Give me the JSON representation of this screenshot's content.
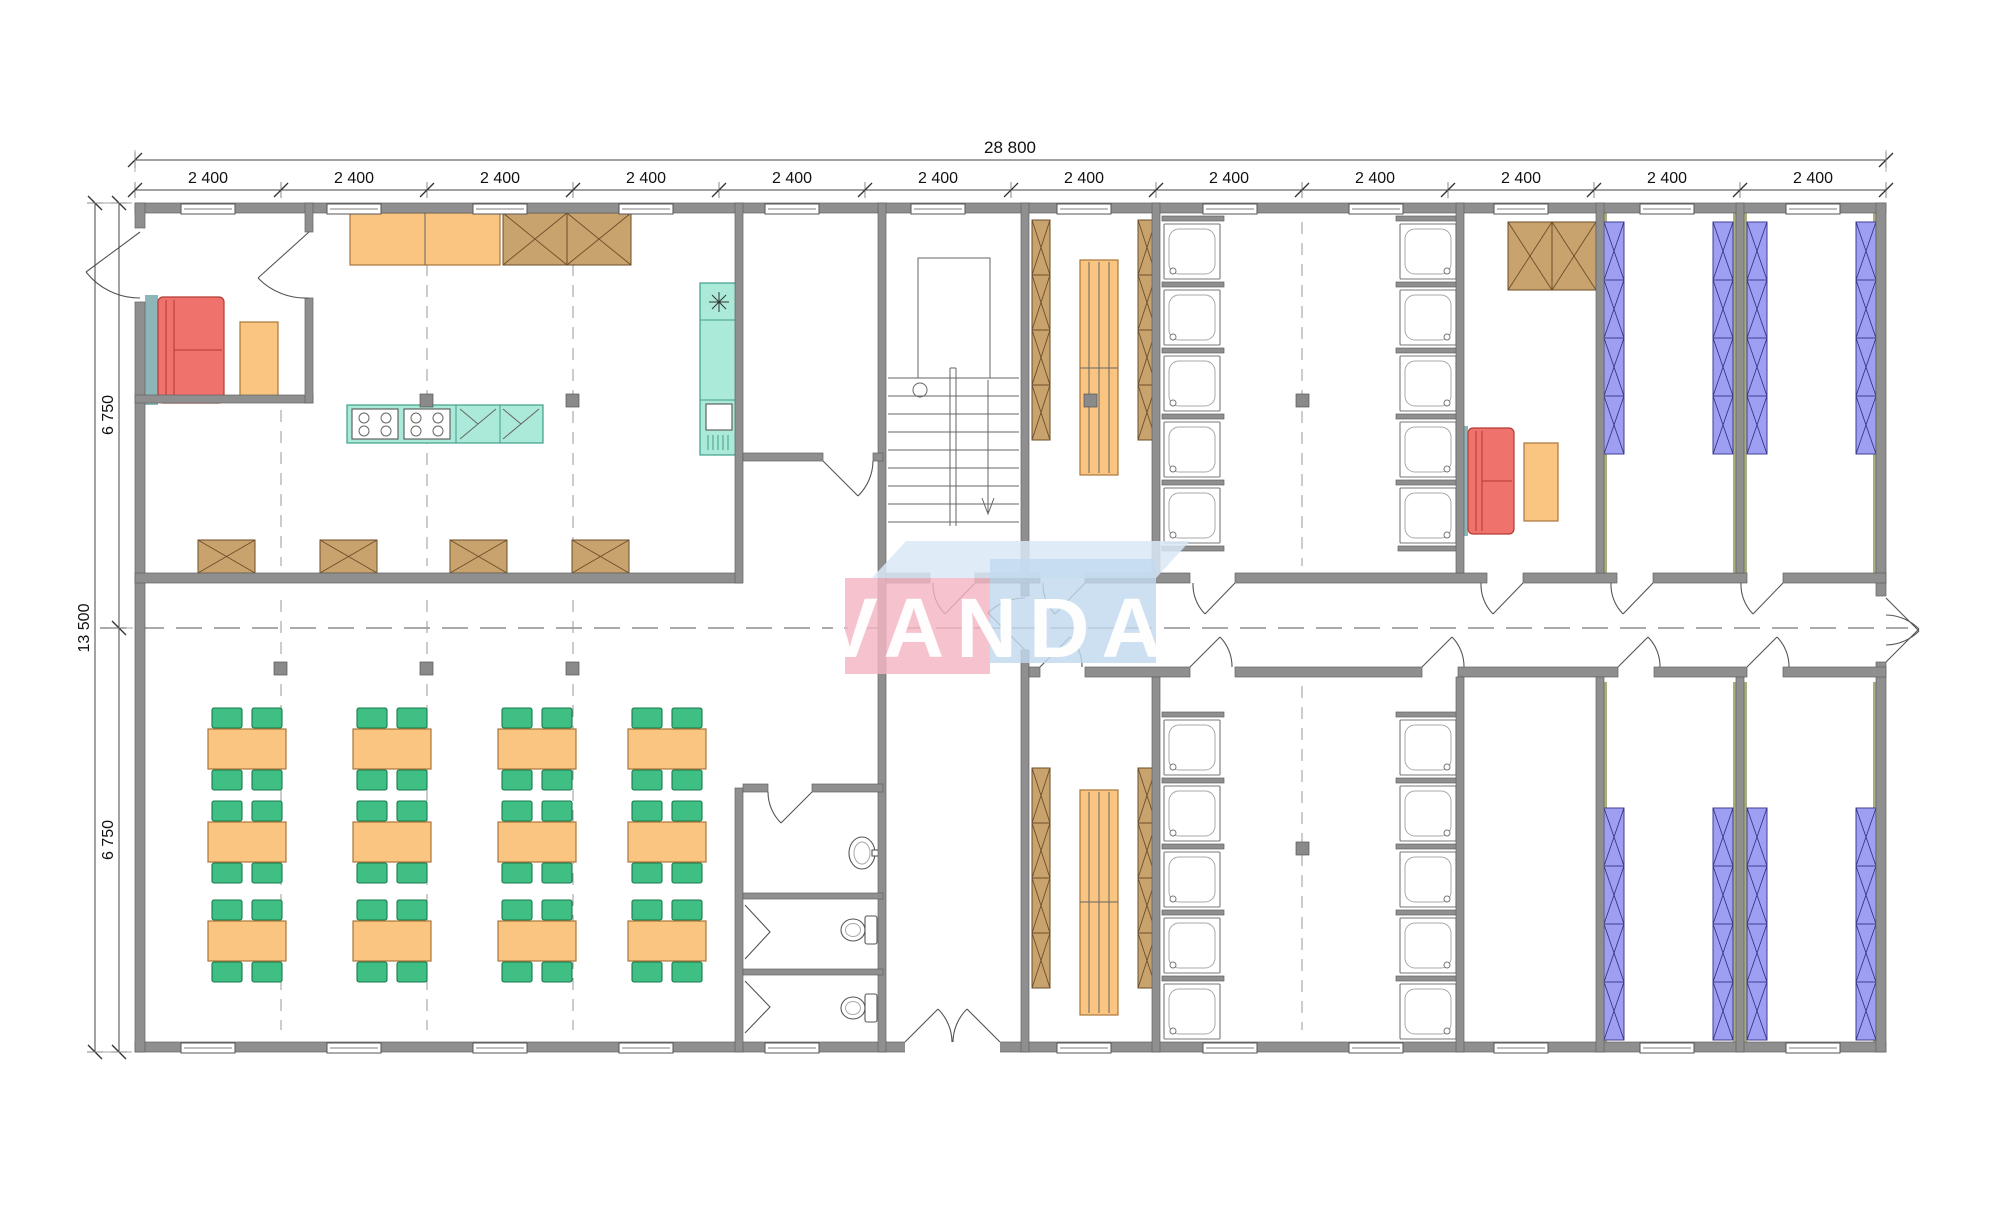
{
  "watermark": {
    "text": "VANDA"
  },
  "dimensions": {
    "total_width": "28 800",
    "total_depth": "13 500",
    "bay_labels": [
      "2 400",
      "2 400",
      "2 400",
      "2 400",
      "2 400",
      "2 400",
      "2 400",
      "2 400",
      "2 400",
      "2 400",
      "2 400",
      "2 400"
    ],
    "half_depth_labels": [
      "6 750",
      "6 750"
    ]
  },
  "palette": {
    "wall": "#8f8f8f",
    "orange": "#fac481",
    "brown": "#c9a36e",
    "green": "#3fbf83",
    "teal": "#abe9d9",
    "red": "#f0726d",
    "bunk": "#9e9ef2",
    "teal_stripe": "#8cb6b8",
    "olive": "#a9ae7c",
    "wm_pink": "#f4b5c2",
    "wm_blue": "#c2d9ee",
    "wm_blue_top": "#d9e9f6"
  },
  "inventory": {
    "dining_tables": 12,
    "chairs": 48,
    "shower_stalls": 20,
    "wc_stalls": 2,
    "washbasins": 1,
    "bunk_bed_stacks": 8,
    "locker_columns": 4,
    "benches": 2,
    "sofas": 2,
    "coffee_tables": 2,
    "cooktops": 2,
    "staircases": 1
  }
}
